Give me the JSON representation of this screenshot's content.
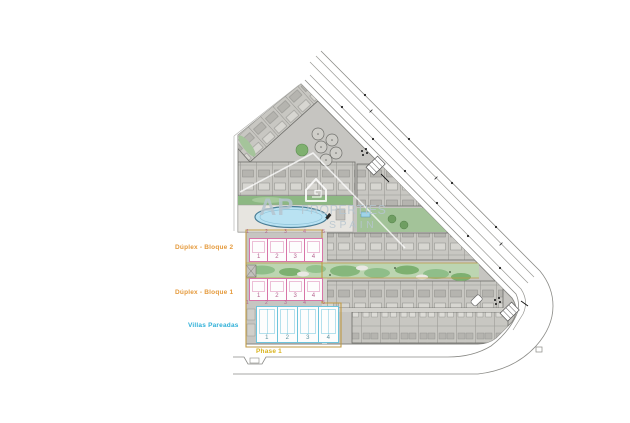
{
  "labels": {
    "bloque2": "Dúplex - Bloque 2",
    "bloque1": "Dúplex - Bloque 1",
    "villas": "Villas Pareadas",
    "phase": "Phase 1"
  },
  "watermark": {
    "initials": "AP",
    "word": "PROPERTIES",
    "country": "SPAIN",
    "icon": "house-logo-icon"
  },
  "blocks": {
    "bloque2": {
      "units": [
        "1",
        "2",
        "3",
        "4"
      ],
      "plots": [
        "1",
        "2",
        "3",
        "4",
        "5"
      ]
    },
    "bloque1": {
      "units": [
        "1",
        "2",
        "3",
        "4"
      ],
      "plots": [
        "1",
        "2",
        "3",
        "4",
        "5"
      ]
    },
    "villas": {
      "units": [
        "1",
        "2",
        "3",
        "4"
      ]
    }
  },
  "colors": {
    "duplex_label": "#E59A3C",
    "villas_label": "#2FB0D8",
    "phase_label": "#D9B31C",
    "duplex_outline": "#D874A8",
    "villas_outline": "#6CC4DC",
    "phase_outline": "#BF9A44",
    "pool_fill": "#B9E2F2",
    "site_fill": "#C6C5C1",
    "green_main": "#BCD5B1",
    "watermark_text": "#B6C5CF"
  }
}
